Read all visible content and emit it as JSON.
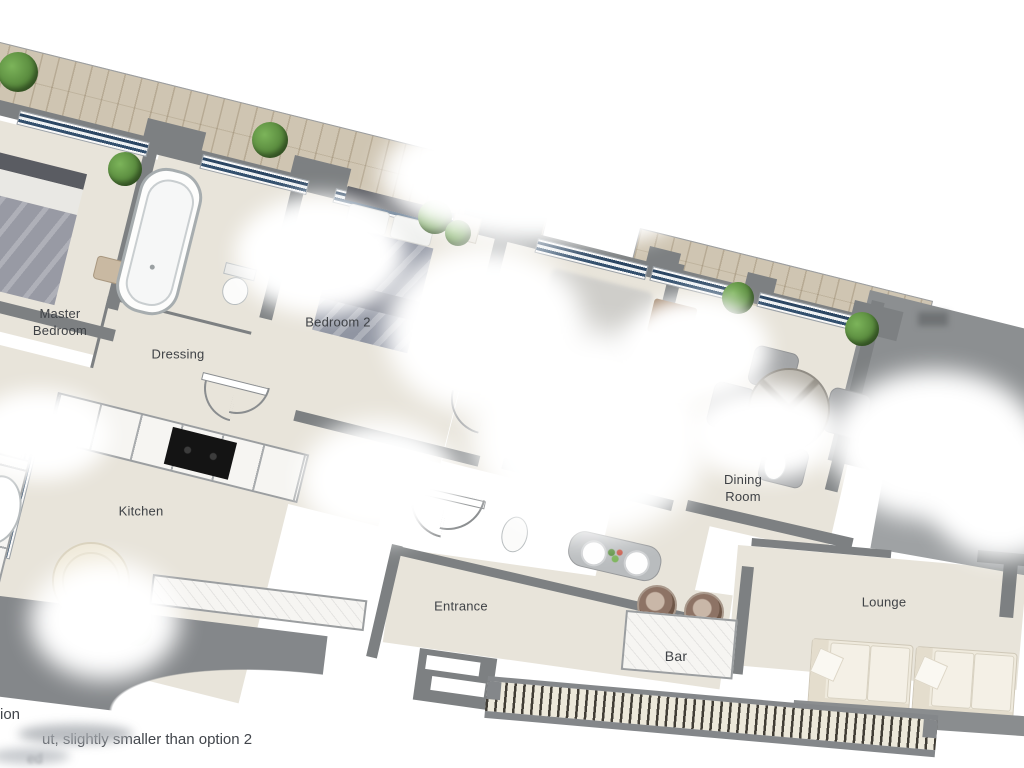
{
  "caption": {
    "line1": "ion",
    "line2": "ut, slightly smaller than option 2",
    "line3": "ed"
  },
  "rooms": {
    "master_bedroom": {
      "label": "Master\nBedroom"
    },
    "dressing": {
      "label": "Dressing"
    },
    "bedroom_2": {
      "label": "Bedroom 2"
    },
    "kitchen": {
      "label": "Kitchen"
    },
    "dining_room": {
      "label": "Dining\nRoom"
    },
    "entrance": {
      "label": "Entrance"
    },
    "bar": {
      "label": "Bar"
    },
    "lounge": {
      "label": "Lounge"
    }
  },
  "fixtures": {
    "topiary_bush": "round clipped shrub on terrace",
    "wood_deck": "plank terrace strip along top wall",
    "window": "dark blue double-glass strip in gray wall",
    "bathtub": "oval tub in bathroom",
    "toilet": "wc beside tub",
    "double_bed": "bed with pillows and grey duvet",
    "dining_table": "round table with four chairs",
    "kitchen_counter": "white marble counter with black cooktop",
    "round_table": "small round breakfast table",
    "console_table": "entry console with two bowls and flowers",
    "bar_counter": "marble bar with two stools",
    "bar_stool": "round brown stool",
    "sofa": "cream lounge sofa",
    "balustrade": "balcony railing with balusters",
    "door_arc": "door swing symbol",
    "washbasin": "small oval basin"
  },
  "colors": {
    "wall": "#7d8082",
    "floor": "#e8e4da",
    "window_glass": "#2b4663",
    "deck_wood": "#cfc5b2",
    "plant_green": "#4e7d35",
    "marble": "#f6f5f2",
    "stool_brown": "#8d7365",
    "sofa_cream": "#efeadd",
    "bed_duvet": "#9095a2",
    "cooktop_black": "#141414"
  }
}
